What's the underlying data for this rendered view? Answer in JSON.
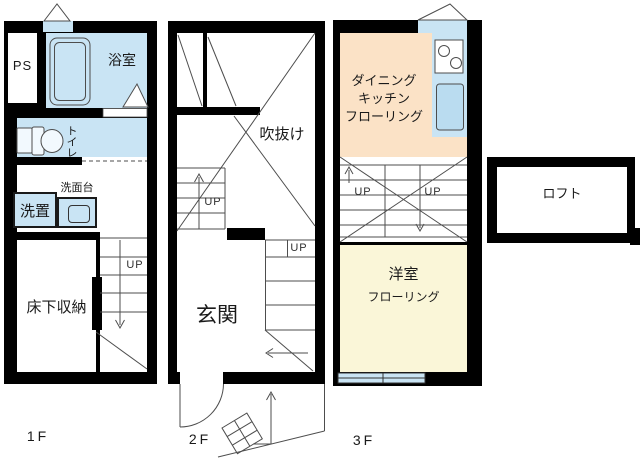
{
  "title": "Maisonette floor plan 1F-3F with loft",
  "colors": {
    "wall": "#000000",
    "water_fixture_blue": "#c9e4f4",
    "sink_blue": "#badcf0",
    "dining_kitchen_peach": "#fbe2c6",
    "western_room_cream": "#faf6d8",
    "line": "#4d4d4d"
  },
  "floor1": {
    "label": "1F",
    "rooms": {
      "pipe_space": "PS",
      "bath": "浴室",
      "toilet": "トイレ",
      "washstand": "洗面台",
      "laundry": "洗置",
      "underfloor_storage": "床下収納"
    },
    "stair_up": "UP"
  },
  "floor2": {
    "label": "2F",
    "rooms": {
      "atrium_void": "吹抜け",
      "entrance": "玄関"
    },
    "stair_up_lower": "UP",
    "stair_up_upper": "UP"
  },
  "floor3": {
    "label": "3F",
    "rooms": {
      "dining_kitchen": [
        "ダイニング",
        "キッチン",
        "フローリング"
      ],
      "western_room": [
        "洋室",
        "フローリング"
      ]
    },
    "stair_up_left": "UP",
    "stair_up_right": "UP"
  },
  "loft": {
    "label": "ロフト"
  }
}
